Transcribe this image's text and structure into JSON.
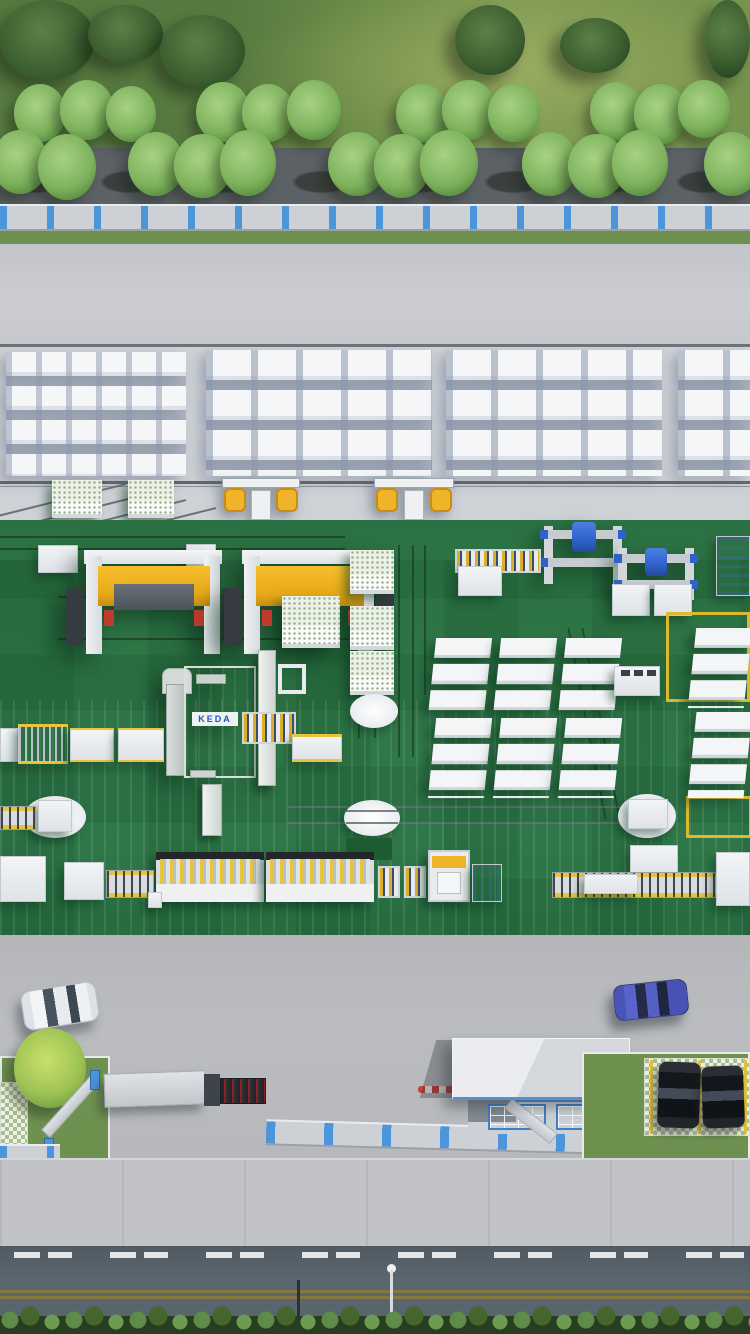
{
  "scene": {
    "description": "Aerial 3D rendering of an AAC block factory site",
    "areas": [
      "tree belt",
      "perimeter fence",
      "storage yard with block stacks",
      "green production floor with machinery",
      "factory gate with guard house",
      "parking",
      "public road"
    ]
  },
  "logo": {
    "text": "KEDA"
  },
  "colors": {
    "floor_green": "#2e7546",
    "accent_yellow": "#f0b42a",
    "marking_yellow": "#ddb92e",
    "fence_blue": "#4a95dc",
    "hoist_blue": "#2f62c9",
    "machine_white": "#eef0f2",
    "block_white": "#f4f6f8",
    "logo_blue": "#1a57c9",
    "red_accent": "#c03a2e",
    "road_dark": "#5c666e",
    "asphalt_mid": "#b8babd",
    "grass_green": "#6f9150",
    "tree_light": "#8fbf6e",
    "tree_dark": "#3c5a30",
    "car_blue": "#5560c4",
    "car_white": "#f2f4f6",
    "car_black": "#14171c"
  }
}
